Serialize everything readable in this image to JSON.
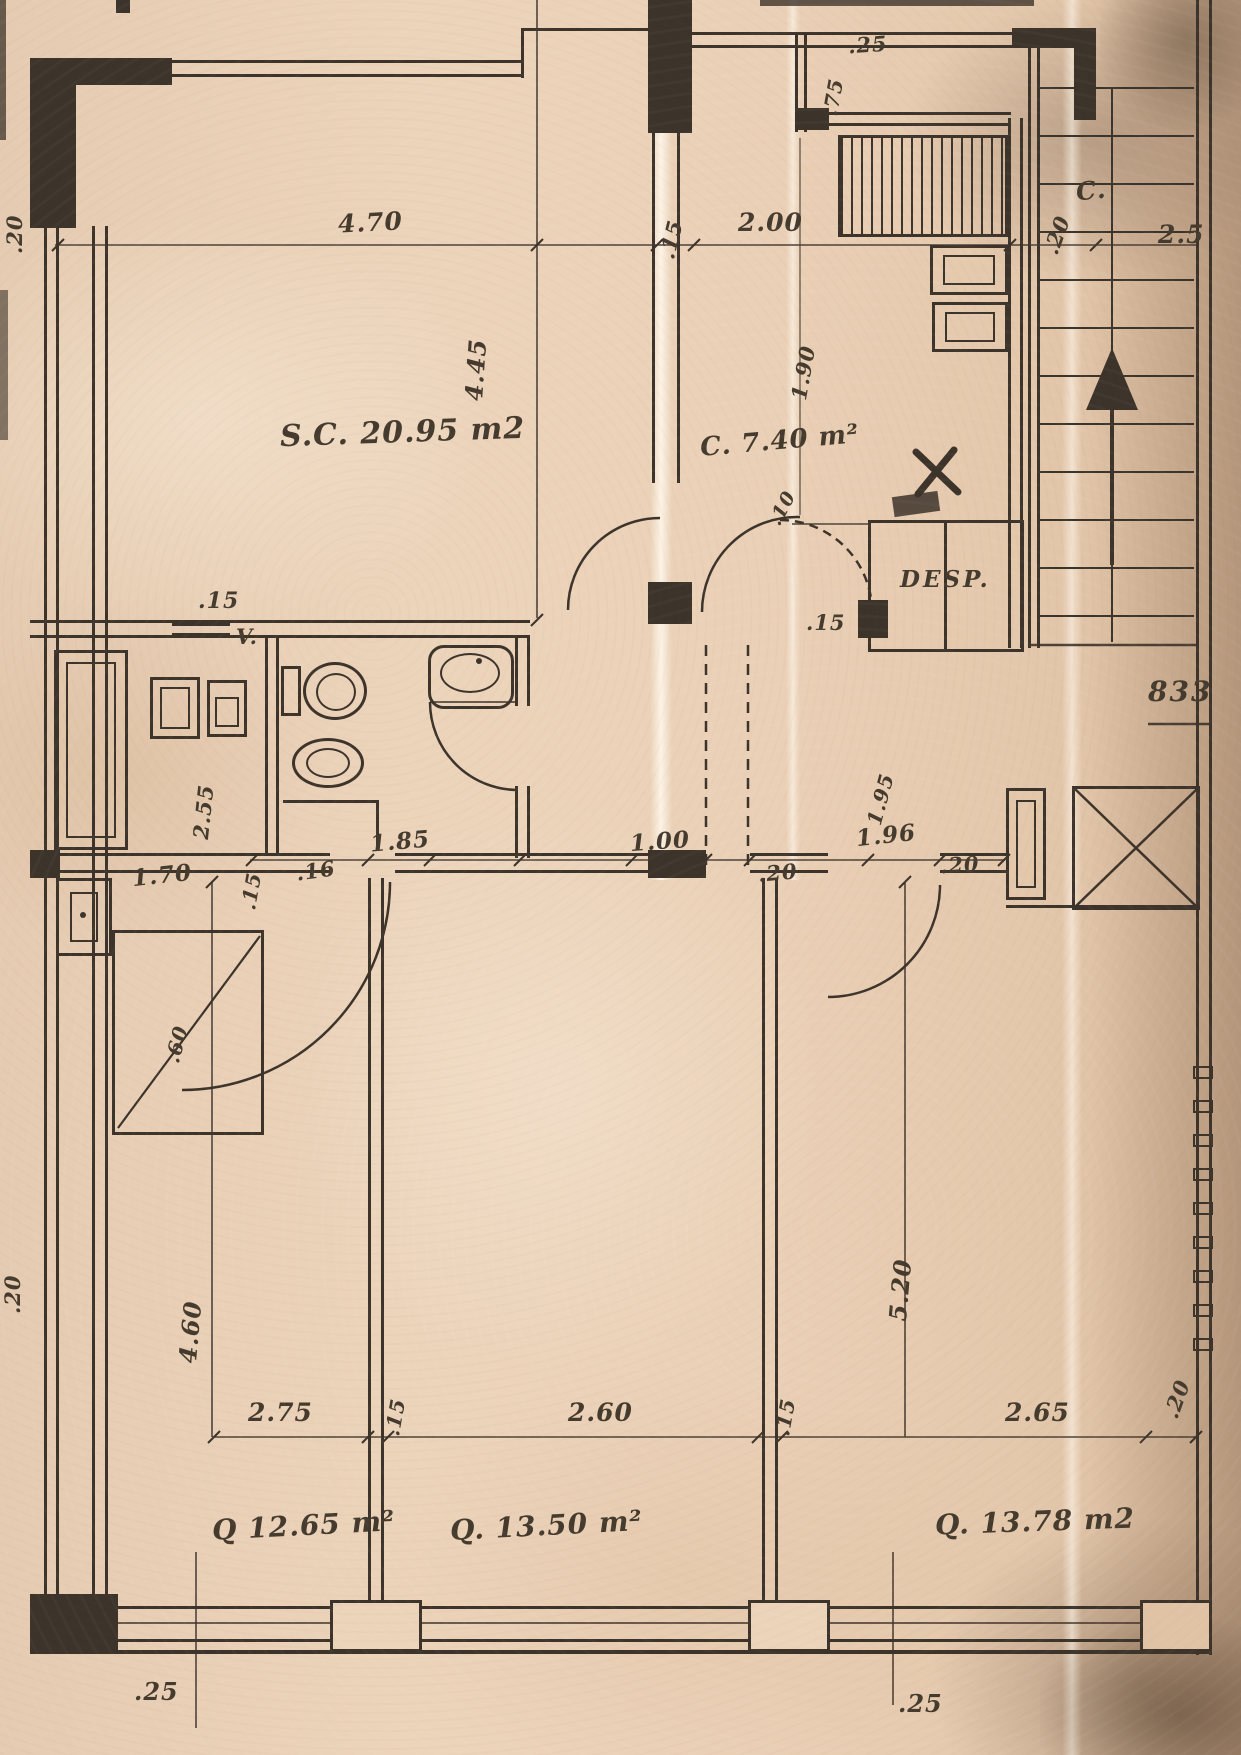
{
  "palette": {
    "paper": "#ecd4bb",
    "ink": "#3c332a",
    "stain": "#a98e76"
  },
  "rooms": {
    "living": "S.C. 20.95 m2",
    "kitchen": "C. 7.40 m²",
    "pantry": "DESP.",
    "hall_c": "C.",
    "vent": "V.",
    "bedroom1": "Q 12.65 m²",
    "bedroom2": "Q. 13.50 m²",
    "bedroom3": "Q. 13.78 m2",
    "plan_number": "833"
  },
  "dims": {
    "top_left_edge_20": ".20",
    "living_width": "4.70",
    "top_wall_15": ".15",
    "kitchen_width": "2.00",
    "top_25": ".25",
    "top_75": ".75",
    "living_height": "4.45",
    "kitchen_right_20": ".20",
    "top_right_25": "2.5",
    "kitchen_height": "1.90",
    "kitchen_10": ".10",
    "hall_door_15": ".15",
    "bath_top_15": ".15",
    "bath_height": "2.55",
    "laundry_width": "1.70",
    "bath_wall_15": ".15",
    "wall_16": ".16",
    "bath_width": "1.85",
    "hall_width": "1.00",
    "hall_20a": ".20",
    "hall_196": "1.96",
    "hall_20b": ".20",
    "hall_height": "1.95",
    "closet_60": ".60",
    "left_edge_20": ".20",
    "bed1_height": "4.60",
    "bed3_height": "5.20",
    "bed1_width": "2.75",
    "wall12_15": ".15",
    "bed2_width": "2.60",
    "wall23_15": ".15",
    "bed3_width": "2.65",
    "bed3_right_20": ".20",
    "bottom_left_25": ".25",
    "bottom_mid_25": ".25"
  },
  "symbols": {
    "stairs_direction": "up-arrow",
    "elevator_shaft": "crossed-box",
    "kitchen_counter": "hatched-rectangle",
    "wardrobe": "diagonal-slash"
  }
}
